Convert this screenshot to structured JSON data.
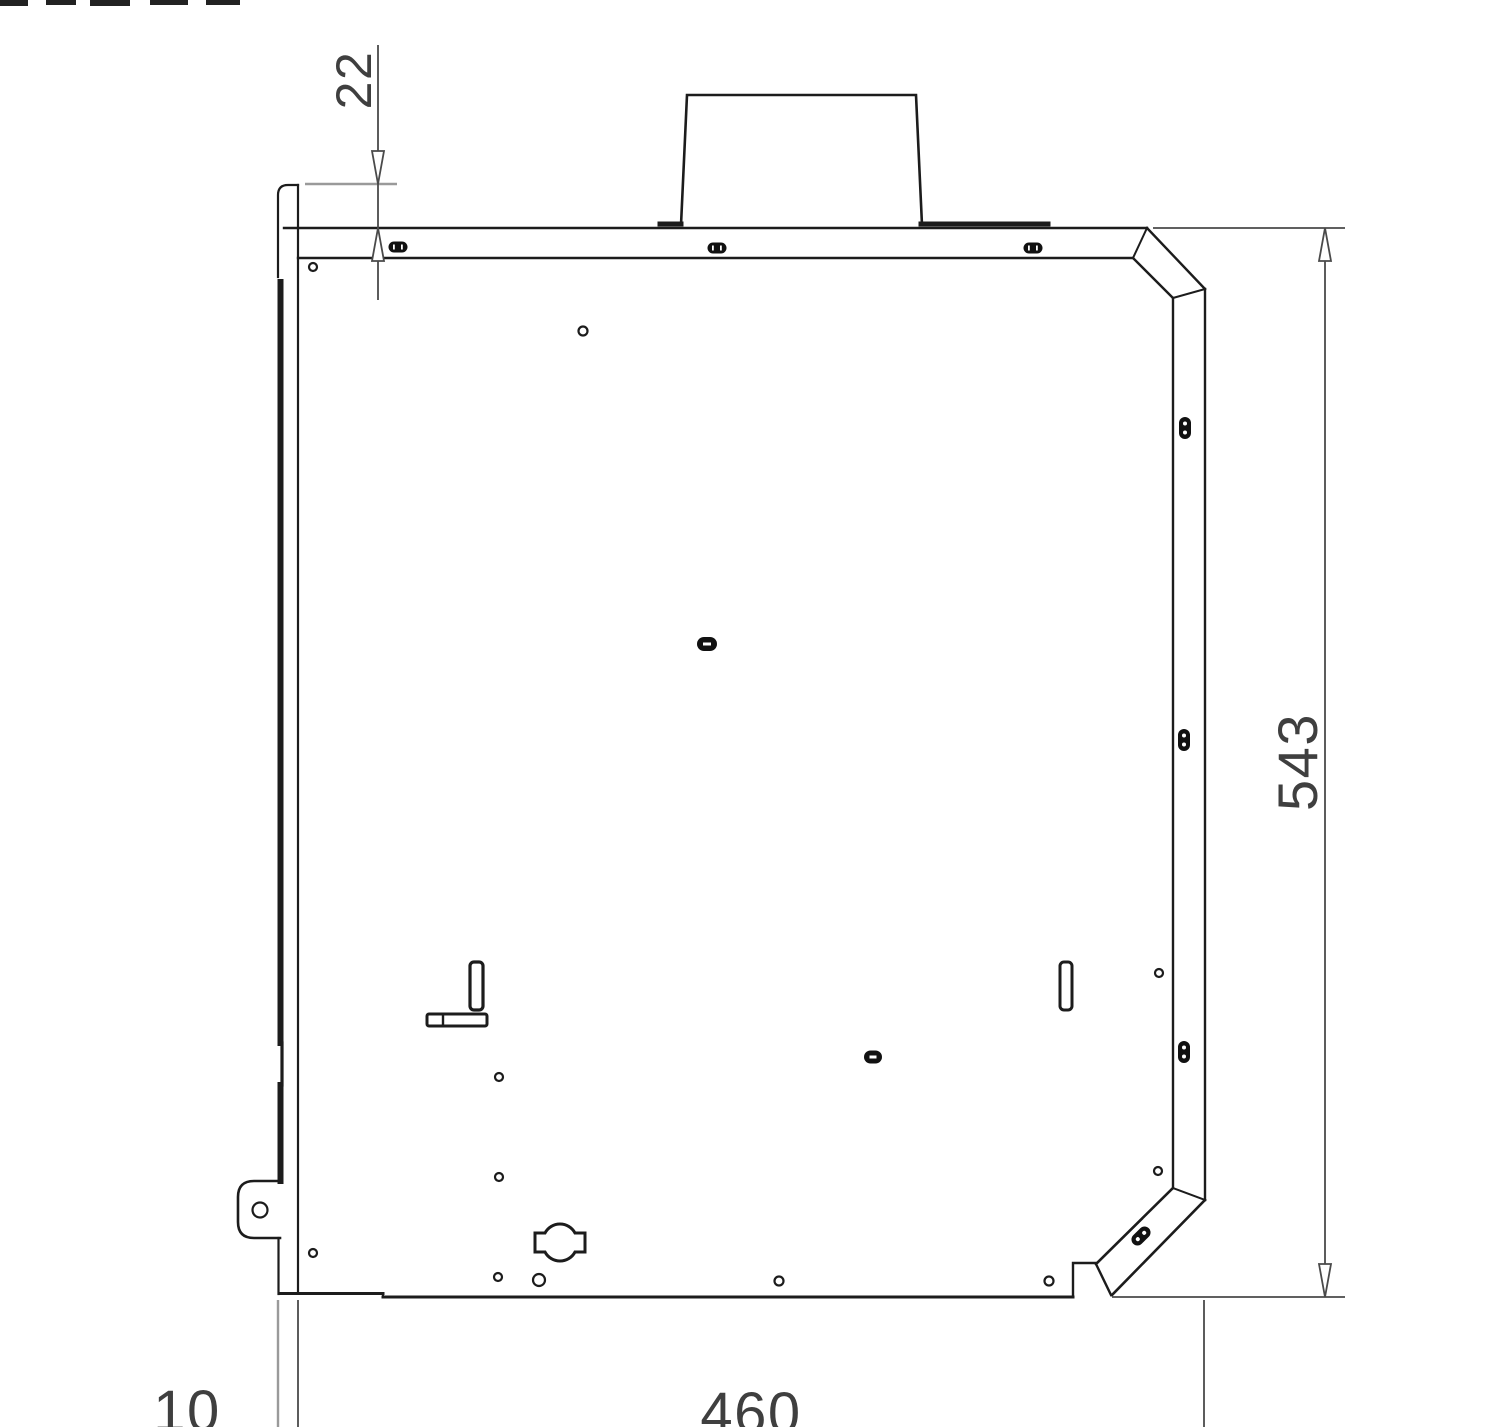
{
  "drawing": {
    "type": "technical-dimension-drawing",
    "view": "appliance side panel with flue collar",
    "dimensions": {
      "flue_offset": "22",
      "overall_height": "543",
      "rear_gap": "10",
      "overall_depth": "460"
    },
    "colors": {
      "outline": "#1c1c1c",
      "dimension_line": "#4a4a4a",
      "extension_gray": "#9a9a9a",
      "text": "#3f3f3f",
      "background": "#ffffff"
    }
  }
}
